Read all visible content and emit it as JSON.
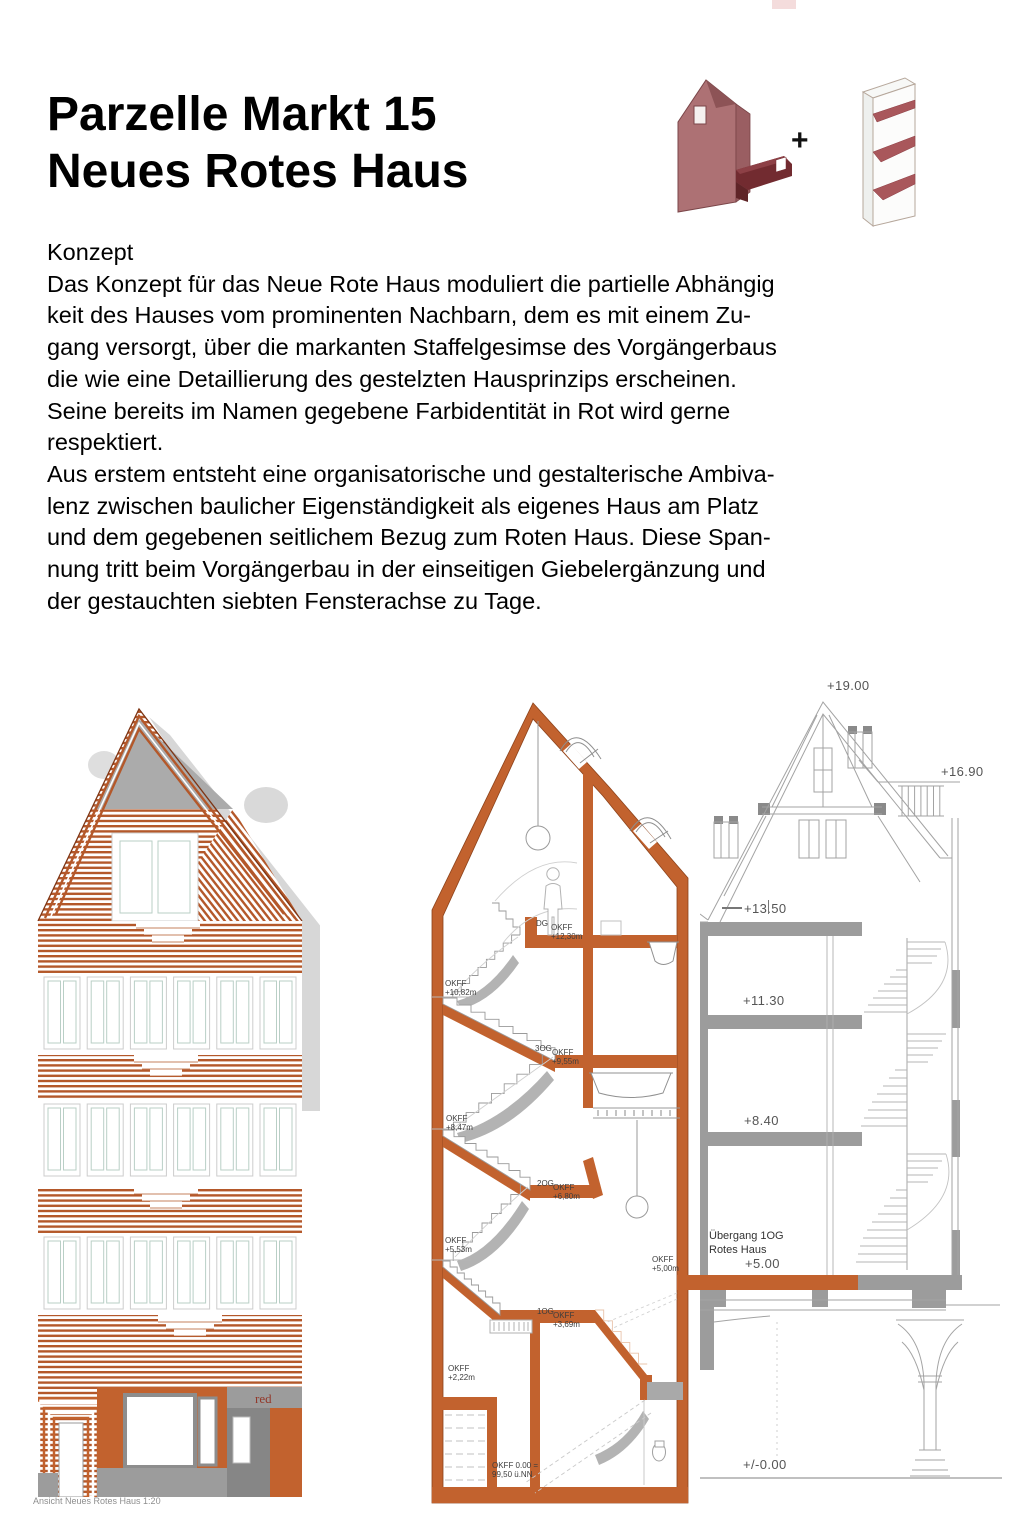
{
  "header": {
    "title_line1": "Parzelle Markt 15",
    "title_line2": "Neues Rotes Haus",
    "plus": "+"
  },
  "concept": {
    "heading": "Konzept",
    "body": "Das Konzept für das Neue Rote Haus moduliert die partielle Abhängig\nkeit des Hauses vom prominenten Nachbarn, dem es mit einem Zu-\ngang versorgt, über die markanten Staffelgesimse des Vorgängerbaus\ndie wie eine Detaillierung des gestelzten Hausprinzips erscheinen.\nSeine bereits im Namen gegebene Farbidentität  in Rot wird gerne\nrespektiert.\nAus erstem entsteht eine organisatorische und gestalterische Ambiva-\nlenz zwischen baulicher Eigenständigkeit als eigenes Haus am Platz\nund dem gegebenen seitlichem Bezug zum Roten Haus. Diese Span-\nnung tritt beim Vorgängerbau in der einseitigen Giebelergänzung und\nder gestauchten siebten Fensterachse zu Tage."
  },
  "elevation": {
    "caption": "Ansicht Neues Rotes Haus 1:20",
    "storefront_label": "red"
  },
  "section": {
    "labels": [
      "DG",
      "OKFF\n+12,30m",
      "OKFF\n+10,82m",
      "3OG",
      "OKFF\n+9,55m",
      "OKFF\n+8,47m",
      "2OG",
      "OKFF\n+6,80m",
      "OKFF\n+5,53m",
      "OKFF\n+5,00m",
      "1OG",
      "OKFF\n+3,69m",
      "OKFF\n+2,22m",
      "OKFF 0.00 =\n99,50 ü.NN"
    ]
  },
  "rotes_haus": {
    "labels": [
      "+19.00",
      "+16.90",
      "+13.50",
      "+11.30",
      "+8.40",
      "+5.00",
      "+/-0.00"
    ],
    "uebergang": "Übergang 1OG\nRotes Haus"
  },
  "colors": {
    "accent_orange": "#c2622e",
    "stripe_orange": "#b4582a",
    "wall_gray": "#9c9c9c",
    "logo_red": "#7e3136"
  }
}
